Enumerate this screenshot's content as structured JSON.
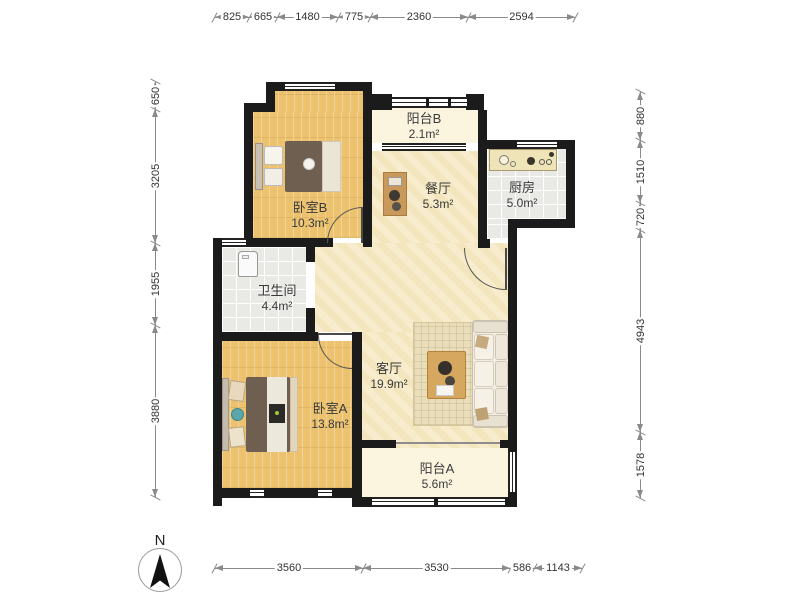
{
  "plan": {
    "title": "apartment-floor-plan",
    "rooms": [
      {
        "id": "bedroom_b",
        "name": "卧室B",
        "area": "10.3m²"
      },
      {
        "id": "balcony_b",
        "name": "阳台B",
        "area": "2.1m²"
      },
      {
        "id": "dining",
        "name": "餐厅",
        "area": "5.3m²"
      },
      {
        "id": "kitchen",
        "name": "厨房",
        "area": "5.0m²"
      },
      {
        "id": "bathroom",
        "name": "卫生间",
        "area": "4.4m²"
      },
      {
        "id": "living",
        "name": "客厅",
        "area": "19.9m²"
      },
      {
        "id": "bedroom_a",
        "name": "卧室A",
        "area": "13.8m²"
      },
      {
        "id": "balcony_a",
        "name": "阳台A",
        "area": "5.6m²"
      }
    ],
    "dimensions": {
      "top": [
        "825",
        "665",
        "1480",
        "775",
        "2360",
        "2594"
      ],
      "left": [
        "650",
        "3205",
        "1955",
        "3880"
      ],
      "right": [
        "880",
        "1510",
        "720",
        "4943",
        "1578"
      ],
      "bottom": [
        "3560",
        "3530",
        "586",
        "1143"
      ]
    },
    "compass": {
      "label": "N"
    },
    "furniture": [
      "double-bed",
      "double-bed",
      "sofa",
      "coffee-table",
      "rug",
      "dining-cabinet",
      "kitchen-counter",
      "washing-machine"
    ],
    "colors": {
      "wall": "#1b1b1b",
      "wood_floor": "#ECC26E",
      "marble_floor": "#F6E9C3",
      "tile_floor": "#E9E9E5",
      "balcony_floor": "#FBF5E0",
      "dimension_line": "#8a8a8a"
    }
  }
}
